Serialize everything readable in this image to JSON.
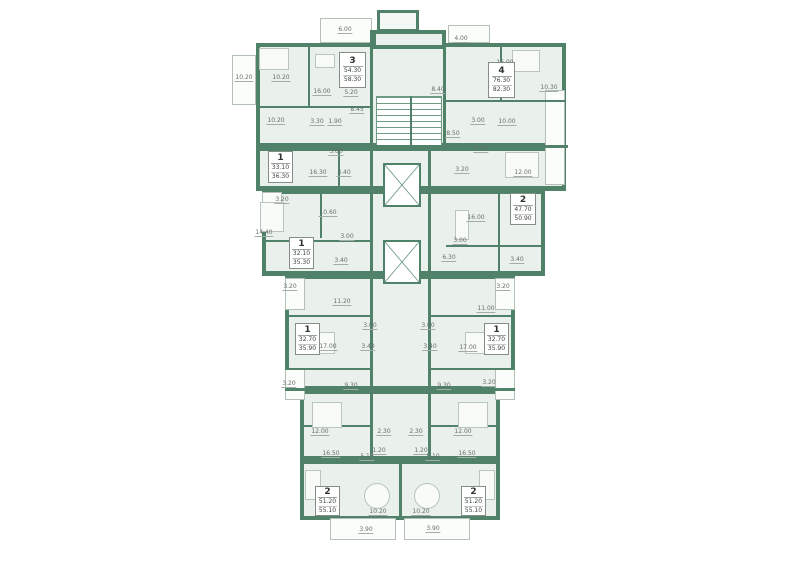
{
  "plan": {
    "title": "residential-floor-plan",
    "colors": {
      "wall": "#4f8269",
      "floor": "#eaf1ec",
      "balcony_line": "#b4bfb7",
      "label_text": "#686e6a"
    },
    "apartments": [
      {
        "rooms_count": "3",
        "area_living": "54.30",
        "area_total": "58.30",
        "box": [
          339,
          52,
          27,
          36
        ]
      },
      {
        "rooms_count": "4",
        "area_living": "76.30",
        "area_total": "82.30",
        "box": [
          488,
          62,
          27,
          36
        ]
      },
      {
        "rooms_count": "1",
        "area_living": "33.10",
        "area_total": "36.30",
        "box": [
          268,
          151,
          25,
          32
        ]
      },
      {
        "rooms_count": "1",
        "area_living": "32.10",
        "area_total": "35.30",
        "box": [
          289,
          237,
          25,
          32
        ]
      },
      {
        "rooms_count": "2",
        "area_living": "47.70",
        "area_total": "50.90",
        "box": [
          510,
          193,
          26,
          32
        ]
      },
      {
        "rooms_count": "1",
        "area_living": "32.70",
        "area_total": "35.90",
        "box": [
          295,
          323,
          25,
          32
        ]
      },
      {
        "rooms_count": "1",
        "area_living": "32.70",
        "area_total": "35.90",
        "box": [
          484,
          323,
          25,
          32
        ]
      },
      {
        "rooms_count": "2",
        "area_living": "51.20",
        "area_total": "55.10",
        "box": [
          315,
          486,
          25,
          30
        ]
      },
      {
        "rooms_count": "2",
        "area_living": "51.20",
        "area_total": "55.10",
        "box": [
          461,
          486,
          25,
          30
        ]
      }
    ],
    "room_labels": [
      {
        "t": "10.20",
        "x": 244,
        "y": 78
      },
      {
        "t": "6.00",
        "x": 345,
        "y": 30
      },
      {
        "t": "10.20",
        "x": 281,
        "y": 78
      },
      {
        "t": "16.00",
        "x": 322,
        "y": 92
      },
      {
        "t": "5.20",
        "x": 351,
        "y": 93
      },
      {
        "t": "10.20",
        "x": 276,
        "y": 121
      },
      {
        "t": "3.30",
        "x": 317,
        "y": 122
      },
      {
        "t": "1.90",
        "x": 335,
        "y": 122
      },
      {
        "t": "8.45",
        "x": 357,
        "y": 110
      },
      {
        "t": "4.00",
        "x": 461,
        "y": 39
      },
      {
        "t": "16.00",
        "x": 505,
        "y": 63
      },
      {
        "t": "10.30",
        "x": 549,
        "y": 88
      },
      {
        "t": "8.40",
        "x": 438,
        "y": 90
      },
      {
        "t": "3.00",
        "x": 478,
        "y": 121
      },
      {
        "t": "10.00",
        "x": 507,
        "y": 122
      },
      {
        "t": "8.50",
        "x": 453,
        "y": 134
      },
      {
        "t": "7.70",
        "x": 481,
        "y": 149
      },
      {
        "t": "3.20",
        "x": 462,
        "y": 170
      },
      {
        "t": "12.00",
        "x": 523,
        "y": 173
      },
      {
        "t": "3.00",
        "x": 336,
        "y": 152
      },
      {
        "t": "16.30",
        "x": 318,
        "y": 173
      },
      {
        "t": "3.40",
        "x": 344,
        "y": 173
      },
      {
        "t": "3.20",
        "x": 282,
        "y": 200
      },
      {
        "t": "14.40",
        "x": 264,
        "y": 233
      },
      {
        "t": "10.60",
        "x": 328,
        "y": 213
      },
      {
        "t": "3.00",
        "x": 347,
        "y": 237
      },
      {
        "t": "3.40",
        "x": 341,
        "y": 261
      },
      {
        "t": "16.00",
        "x": 476,
        "y": 218
      },
      {
        "t": "3.00",
        "x": 460,
        "y": 241
      },
      {
        "t": "6.30",
        "x": 449,
        "y": 258
      },
      {
        "t": "3.40",
        "x": 517,
        "y": 260
      },
      {
        "t": "3.20",
        "x": 290,
        "y": 287
      },
      {
        "t": "11.20",
        "x": 342,
        "y": 302
      },
      {
        "t": "3.00",
        "x": 370,
        "y": 326
      },
      {
        "t": "17.00",
        "x": 328,
        "y": 347
      },
      {
        "t": "3.40",
        "x": 368,
        "y": 347
      },
      {
        "t": "3.20",
        "x": 289,
        "y": 384
      },
      {
        "t": "9.30",
        "x": 351,
        "y": 386
      },
      {
        "t": "3.20",
        "x": 503,
        "y": 287
      },
      {
        "t": "11.00",
        "x": 486,
        "y": 309
      },
      {
        "t": "3.00",
        "x": 428,
        "y": 326
      },
      {
        "t": "17.00",
        "x": 468,
        "y": 348
      },
      {
        "t": "3.40",
        "x": 430,
        "y": 347
      },
      {
        "t": "3.20",
        "x": 489,
        "y": 383
      },
      {
        "t": "9.30",
        "x": 444,
        "y": 386
      },
      {
        "t": "12.00",
        "x": 320,
        "y": 432
      },
      {
        "t": "2.30",
        "x": 384,
        "y": 432
      },
      {
        "t": "2.30",
        "x": 416,
        "y": 432
      },
      {
        "t": "12.00",
        "x": 463,
        "y": 432
      },
      {
        "t": "1.20",
        "x": 379,
        "y": 451
      },
      {
        "t": "1.20",
        "x": 421,
        "y": 451
      },
      {
        "t": "16.50",
        "x": 331,
        "y": 454
      },
      {
        "t": "5.10",
        "x": 367,
        "y": 457
      },
      {
        "t": "5.10",
        "x": 433,
        "y": 457
      },
      {
        "t": "16.50",
        "x": 467,
        "y": 454
      },
      {
        "t": "10.20",
        "x": 378,
        "y": 512
      },
      {
        "t": "10.20",
        "x": 421,
        "y": 512
      },
      {
        "t": "3.90",
        "x": 366,
        "y": 530
      },
      {
        "t": "3.90",
        "x": 433,
        "y": 529
      }
    ],
    "geometry": {
      "blocks": [
        [
          256,
          43,
          310,
          104,
          0
        ],
        [
          372,
          30,
          74,
          19,
          0
        ],
        [
          256,
          147,
          310,
          43,
          0
        ],
        [
          262,
          190,
          283,
          85,
          0
        ],
        [
          285,
          275,
          230,
          115,
          0
        ],
        [
          300,
          390,
          200,
          70,
          0
        ],
        [
          300,
          460,
          200,
          60,
          0
        ],
        [
          377,
          10,
          42,
          22,
          1
        ]
      ],
      "balconies": [
        [
          232,
          55,
          24,
          50
        ],
        [
          320,
          18,
          52,
          25
        ],
        [
          448,
          25,
          42,
          18
        ],
        [
          545,
          90,
          20,
          95
        ],
        [
          262,
          192,
          20,
          40
        ],
        [
          285,
          278,
          20,
          32
        ],
        [
          495,
          278,
          20,
          32
        ],
        [
          285,
          368,
          20,
          32
        ],
        [
          495,
          368,
          20,
          32
        ],
        [
          330,
          518,
          66,
          22
        ],
        [
          404,
          518,
          66,
          22
        ]
      ],
      "walls": [
        [
          370,
          30,
          3,
          430
        ],
        [
          443,
          30,
          3,
          119
        ],
        [
          428,
          147,
          3,
          315
        ],
        [
          256,
          145,
          312,
          3
        ],
        [
          256,
          188,
          310,
          3
        ],
        [
          262,
          273,
          283,
          3
        ],
        [
          285,
          388,
          230,
          3
        ],
        [
          300,
          458,
          200,
          3
        ],
        [
          308,
          43,
          2,
          63
        ],
        [
          256,
          106,
          116,
          2
        ],
        [
          446,
          100,
          120,
          2
        ],
        [
          500,
          43,
          2,
          57
        ],
        [
          338,
          147,
          2,
          41
        ],
        [
          320,
          190,
          2,
          48
        ],
        [
          262,
          240,
          108,
          2
        ],
        [
          498,
          190,
          2,
          83
        ],
        [
          446,
          245,
          97,
          2
        ],
        [
          285,
          315,
          85,
          2
        ],
        [
          430,
          315,
          85,
          2
        ],
        [
          285,
          368,
          85,
          2
        ],
        [
          430,
          368,
          85,
          2
        ],
        [
          300,
          425,
          70,
          2
        ],
        [
          430,
          425,
          70,
          2
        ],
        [
          399,
          460,
          3,
          60
        ],
        [
          410,
          96,
          2,
          50
        ]
      ],
      "elevators": [
        [
          383,
          163,
          38,
          44
        ],
        [
          383,
          240,
          38,
          44
        ]
      ],
      "stairs": [
        [
          376,
          96,
          66,
          50
        ]
      ],
      "furniture_rects": [
        [
          259,
          48,
          30,
          22
        ],
        [
          315,
          54,
          20,
          14
        ],
        [
          512,
          50,
          28,
          22
        ],
        [
          505,
          152,
          34,
          26
        ],
        [
          260,
          202,
          24,
          30
        ],
        [
          455,
          210,
          14,
          30
        ],
        [
          305,
          332,
          30,
          22
        ],
        [
          465,
          332,
          30,
          22
        ],
        [
          312,
          402,
          30,
          26
        ],
        [
          458,
          402,
          30,
          26
        ],
        [
          305,
          470,
          16,
          30
        ],
        [
          479,
          470,
          16,
          30
        ]
      ],
      "furniture_circles": [
        [
          377,
          496,
          13
        ],
        [
          427,
          496,
          13
        ]
      ]
    }
  }
}
